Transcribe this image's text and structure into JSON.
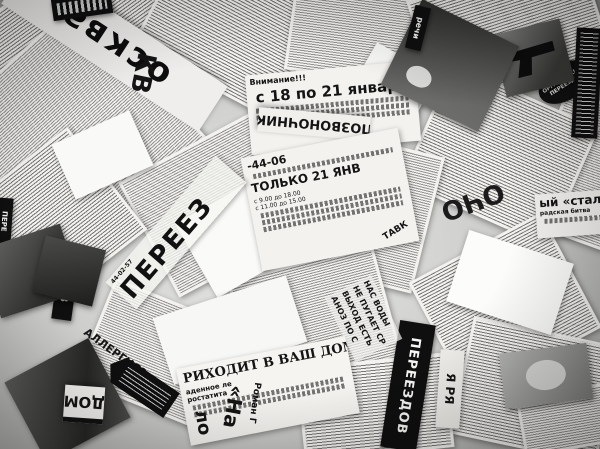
{
  "image": {
    "description": "Black-and-white photograph: collage of overlapping torn Russian newspaper clippings and classified ads scattered at random angles",
    "colors": {
      "paper": "#f3f2ef",
      "ink": "#141414",
      "background": "#9a9a98"
    }
  },
  "fragments": {
    "moskva": "осква",
    "kv": "КВ",
    "attention": "Внимание!!!",
    "date_range": "с 18 по 21 января",
    "pozvonochnik": "ПОЗВОНОЧНИК",
    "phone1": "-44-06",
    "tolko": "ТОЛЬКО 21 ЯНВ",
    "sched1": "с 9.00 до 18.00",
    "sched2": "с 11.00 до 15.00",
    "phone2": "44-02-57",
    "pereez": "ПЕРЕЕЗ",
    "zdov": "ЗДОВ",
    "zatsiya": "ЗАЦИЯ",
    "pere_small": "ПЕРЕ",
    "allergy": "АЛЛЕРГИЯ?",
    "dom": "ДОМ",
    "vash_dom": "РИХОДИТ В ВАШ ДОМ",
    "prost1": "аденное ле",
    "prost2": "ростатита",
    "roman": "Роман Г",
    "na": "«На",
    "lo": "ло",
    "pereezdov": "ПЕРЕЕЗДОВ",
    "ya_rya": "Я РЯ",
    "ocho": "ОЧО",
    "stal": "ый «стал",
    "gradskaya": "радская битва",
    "nas_vody": [
      "НАС ВОДЫ",
      "НЕ ПУГАЕТ СР",
      "ВЫХОД ЕСТЬ",
      "АНОЗ ПО С"
    ],
    "stamp1": "ОРГАНИЗАЦИЯ",
    "stamp2": "ПЕРЕЕЗДОВ",
    "rechi": "речи",
    "stavk": "ТАВК"
  }
}
